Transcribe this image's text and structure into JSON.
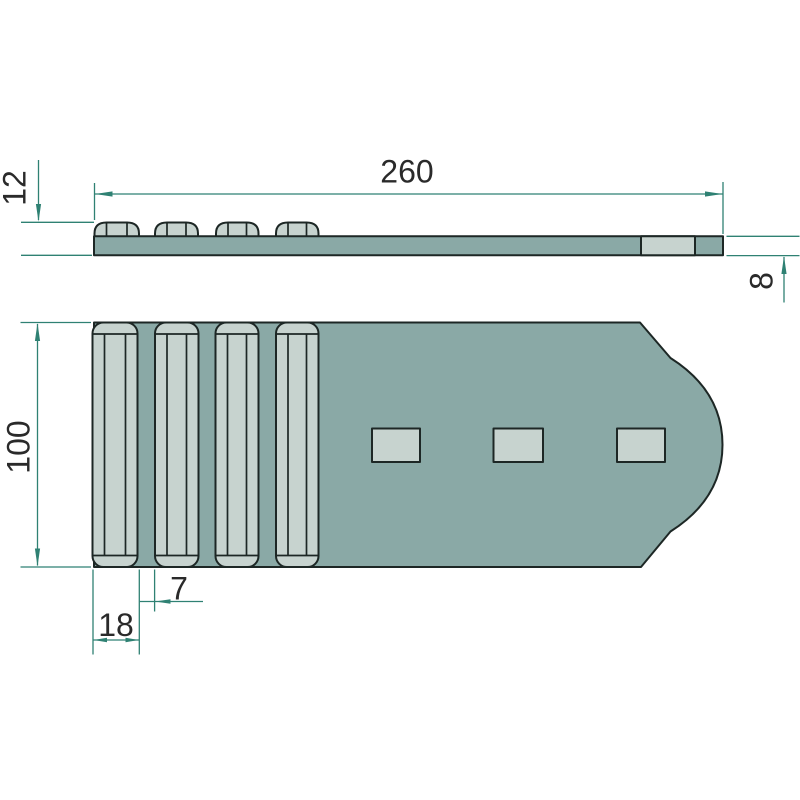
{
  "drawing_title": "Ribbed plate technical drawing, two views",
  "colors": {
    "background": "#ffffff",
    "part_fill": "#8aa9a6",
    "raised_fill": "#c7d3cf",
    "outline": "#1d2725",
    "dimension": "#2f8173",
    "text": "#2a2a2a"
  },
  "dimensions": {
    "overall_length": {
      "label": "260"
    },
    "overall_height": {
      "label": "12"
    },
    "plate_thickness": {
      "label": "8"
    },
    "plate_width": {
      "label": "100"
    },
    "rib_width": {
      "label": "18"
    },
    "rib_gap": {
      "label": "7"
    }
  },
  "geometry": {
    "side_view": {
      "plate": {
        "x": 94,
        "y": 236.3,
        "w": 629,
        "h": 19
      },
      "hole_insert": {
        "x": 641,
        "y": 236.3,
        "w": 54,
        "h": 19
      },
      "bump_top_y": 222.5,
      "bumps_x": [
        [
          94.5,
          139
        ],
        [
          155,
          198
        ],
        [
          216,
          258.5
        ],
        [
          276,
          318.5
        ]
      ]
    },
    "plan_view": {
      "plate_y": [
        322.5,
        567
      ],
      "ribs_x": [
        [
          92.5,
          137.5
        ],
        [
          155,
          198.5
        ],
        [
          215.5,
          258.5
        ],
        [
          276,
          318.5
        ]
      ],
      "rib_corner_radius": 11,
      "rib_facet_inset": 12,
      "rib_facet_ys": [
        334,
        555.5
      ],
      "holes": [
        {
          "x": 372,
          "y": 428.5,
          "w": 48,
          "h": 33.5
        },
        {
          "x": 493.5,
          "y": 428.5,
          "w": 49.5,
          "h": 33.5
        },
        {
          "x": 617,
          "y": 428.5,
          "w": 48,
          "h": 33.5
        }
      ]
    }
  }
}
